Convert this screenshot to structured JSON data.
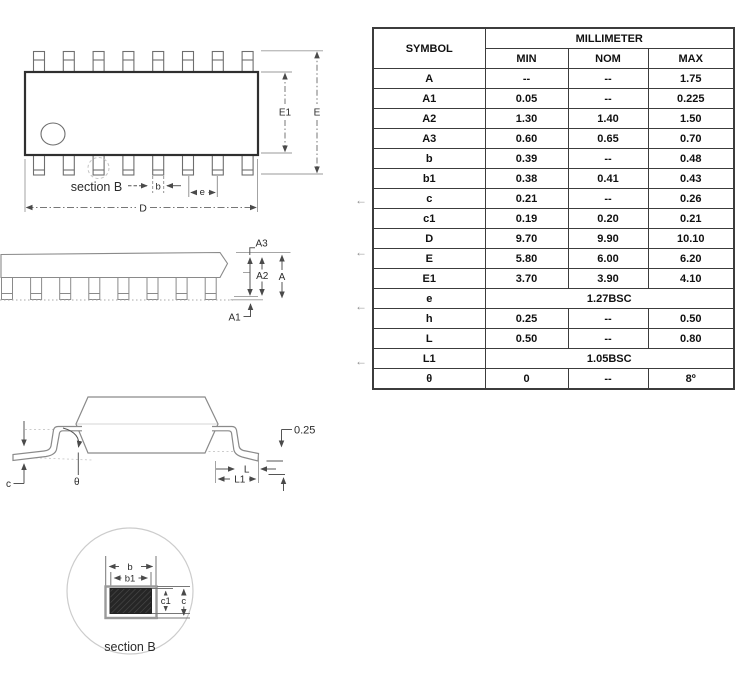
{
  "drawings": {
    "top_view": {
      "section_label": "section B",
      "b": "b",
      "e": "e",
      "d": "D",
      "e1": "E1",
      "e_overall": "E"
    },
    "side_view": {
      "a3": "A3",
      "a2": "A2",
      "a": "A",
      "a1": "A1"
    },
    "front_view": {
      "gauge": "0.25",
      "l": "L",
      "l1": "L1",
      "c": "c",
      "theta": "θ"
    },
    "section_b": {
      "b": "b",
      "b1": "b1",
      "c1": "c1",
      "c": "c",
      "caption": "section B"
    }
  },
  "annotations": {
    "marker_glyph": "←"
  },
  "table": {
    "symbol_header": "SYMBOL",
    "unit_header": "MILLIMETER",
    "col_headers": [
      "MIN",
      "NOM",
      "MAX"
    ],
    "rows": [
      {
        "symbol": "A",
        "min": "--",
        "nom": "--",
        "max": "1.75"
      },
      {
        "symbol": "A1",
        "min": "0.05",
        "nom": "--",
        "max": "0.225"
      },
      {
        "symbol": "A2",
        "min": "1.30",
        "nom": "1.40",
        "max": "1.50"
      },
      {
        "symbol": "A3",
        "min": "0.60",
        "nom": "0.65",
        "max": "0.70"
      },
      {
        "symbol": "b",
        "min": "0.39",
        "nom": "--",
        "max": "0.48"
      },
      {
        "symbol": "b1",
        "min": "0.38",
        "nom": "0.41",
        "max": "0.43"
      },
      {
        "symbol": "c",
        "min": "0.21",
        "nom": "--",
        "max": "0.26"
      },
      {
        "symbol": "c1",
        "min": "0.19",
        "nom": "0.20",
        "max": "0.21"
      },
      {
        "symbol": "D",
        "min": "9.70",
        "nom": "9.90",
        "max": "10.10"
      },
      {
        "symbol": "E",
        "min": "5.80",
        "nom": "6.00",
        "max": "6.20"
      },
      {
        "symbol": "E1",
        "min": "3.70",
        "nom": "3.90",
        "max": "4.10"
      },
      {
        "symbol": "e",
        "span": "1.27BSC"
      },
      {
        "symbol": "h",
        "min": "0.25",
        "nom": "--",
        "max": "0.50"
      },
      {
        "symbol": "L",
        "min": "0.50",
        "nom": "--",
        "max": "0.80"
      },
      {
        "symbol": "L1",
        "span": "1.05BSC"
      },
      {
        "symbol": "θ",
        "min": "0",
        "nom": "--",
        "max": "8º"
      }
    ]
  }
}
